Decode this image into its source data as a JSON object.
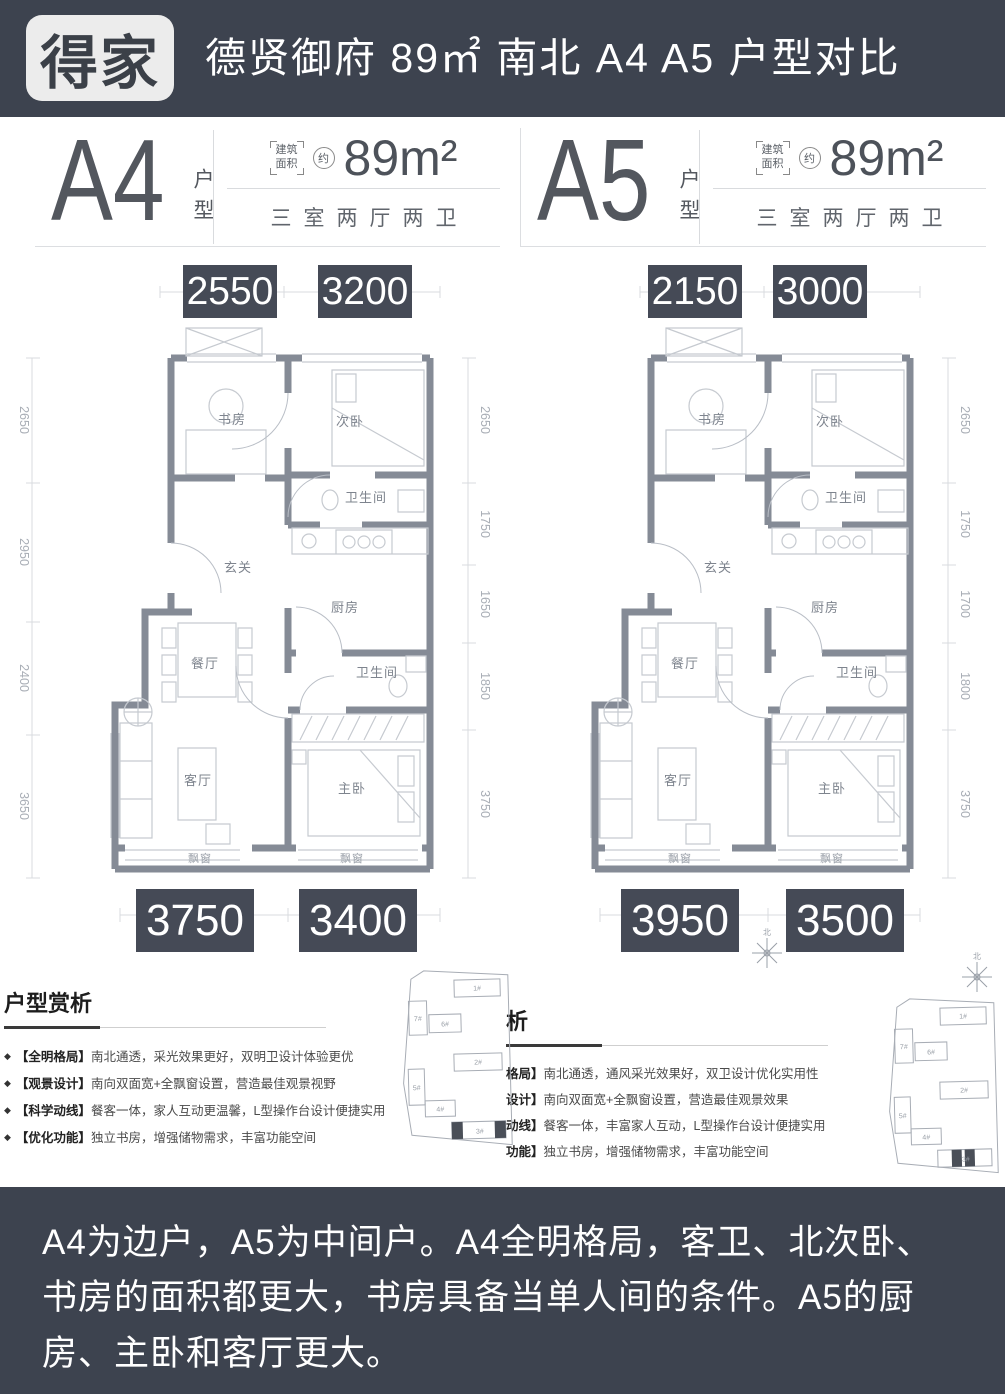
{
  "header": {
    "logo": "得家",
    "title": "德贤御府 89㎡ 南北 A4 A5 户型对比"
  },
  "plans": [
    {
      "name": "A4",
      "type_label": "户型",
      "area_bracket": [
        "建筑",
        "面积"
      ],
      "approx": "约",
      "area": "89m²",
      "layout": "三室两厅两卫",
      "dims_top": [
        "2550",
        "3200"
      ],
      "dims_bottom": [
        "3750",
        "3400"
      ],
      "dims_left": [
        "2650",
        "2950",
        "2400",
        "3650"
      ],
      "dims_right": [
        "2650",
        "1750",
        "1650",
        "1850",
        "3750"
      ],
      "rooms": {
        "study": "书房",
        "bedroom2": "次卧",
        "bath1": "卫生间",
        "foyer": "玄关",
        "kitchen": "厨房",
        "dining": "餐厅",
        "bath2": "卫生间",
        "living": "客厅",
        "master": "主卧",
        "bay1": "飘窗",
        "bay2": "飘窗"
      }
    },
    {
      "name": "A5",
      "type_label": "户型",
      "area_bracket": [
        "建筑",
        "面积"
      ],
      "approx": "约",
      "area": "89m²",
      "layout": "三室两厅两卫",
      "dims_top": [
        "2150",
        "3000"
      ],
      "dims_bottom": [
        "3950",
        "3500"
      ],
      "dims_right": [
        "2650",
        "1750",
        "1700",
        "1800",
        "3750"
      ],
      "rooms": {
        "study": "书房",
        "bedroom2": "次卧",
        "bath1": "卫生间",
        "foyer": "玄关",
        "kitchen": "厨房",
        "dining": "餐厅",
        "bath2": "卫生间",
        "living": "客厅",
        "master": "主卧",
        "bay1": "飘窗",
        "bay2": "飘窗"
      }
    }
  ],
  "analysis_left": {
    "title": "户型赏析",
    "marker": "◆",
    "bullets": [
      {
        "label": "【全明格局】",
        "text": "南北通透，采光效果更好，双明卫设计体验更优"
      },
      {
        "label": "【观景设计】",
        "text": "南向双面宽+全飘窗设置，营造最佳观景视野"
      },
      {
        "label": "【科学动线】",
        "text": "餐客一体，家人互动更温馨，L型操作台设计便捷实用"
      },
      {
        "label": "【优化功能】",
        "text": "独立书房，增强储物需求，丰富功能空间"
      }
    ]
  },
  "analysis_right": {
    "title": "析",
    "bullets": [
      {
        "label": "格局】",
        "text": "南北通透，通风采光效果好，双卫设计优化实用性"
      },
      {
        "label": "设计】",
        "text": "南向双面宽+全飘窗设置，营造最佳观景效果"
      },
      {
        "label": "动线】",
        "text": "餐客一体，丰富家人互动，L型操作台设计便捷实用"
      },
      {
        "label": "功能】",
        "text": "独立书房，增强储物需求，丰富功能空间"
      }
    ]
  },
  "site_plan": {
    "buildings": [
      "1#",
      "2#",
      "3#",
      "4#",
      "5#",
      "6#",
      "7#"
    ],
    "compass": "北"
  },
  "footer": {
    "text": "A4为边户，A5为中间户。A4全明格局，客卫、北次卧、书房的面积都更大，书房具备当单人间的条件。A5的厨房、主卧和客厅更大。"
  }
}
